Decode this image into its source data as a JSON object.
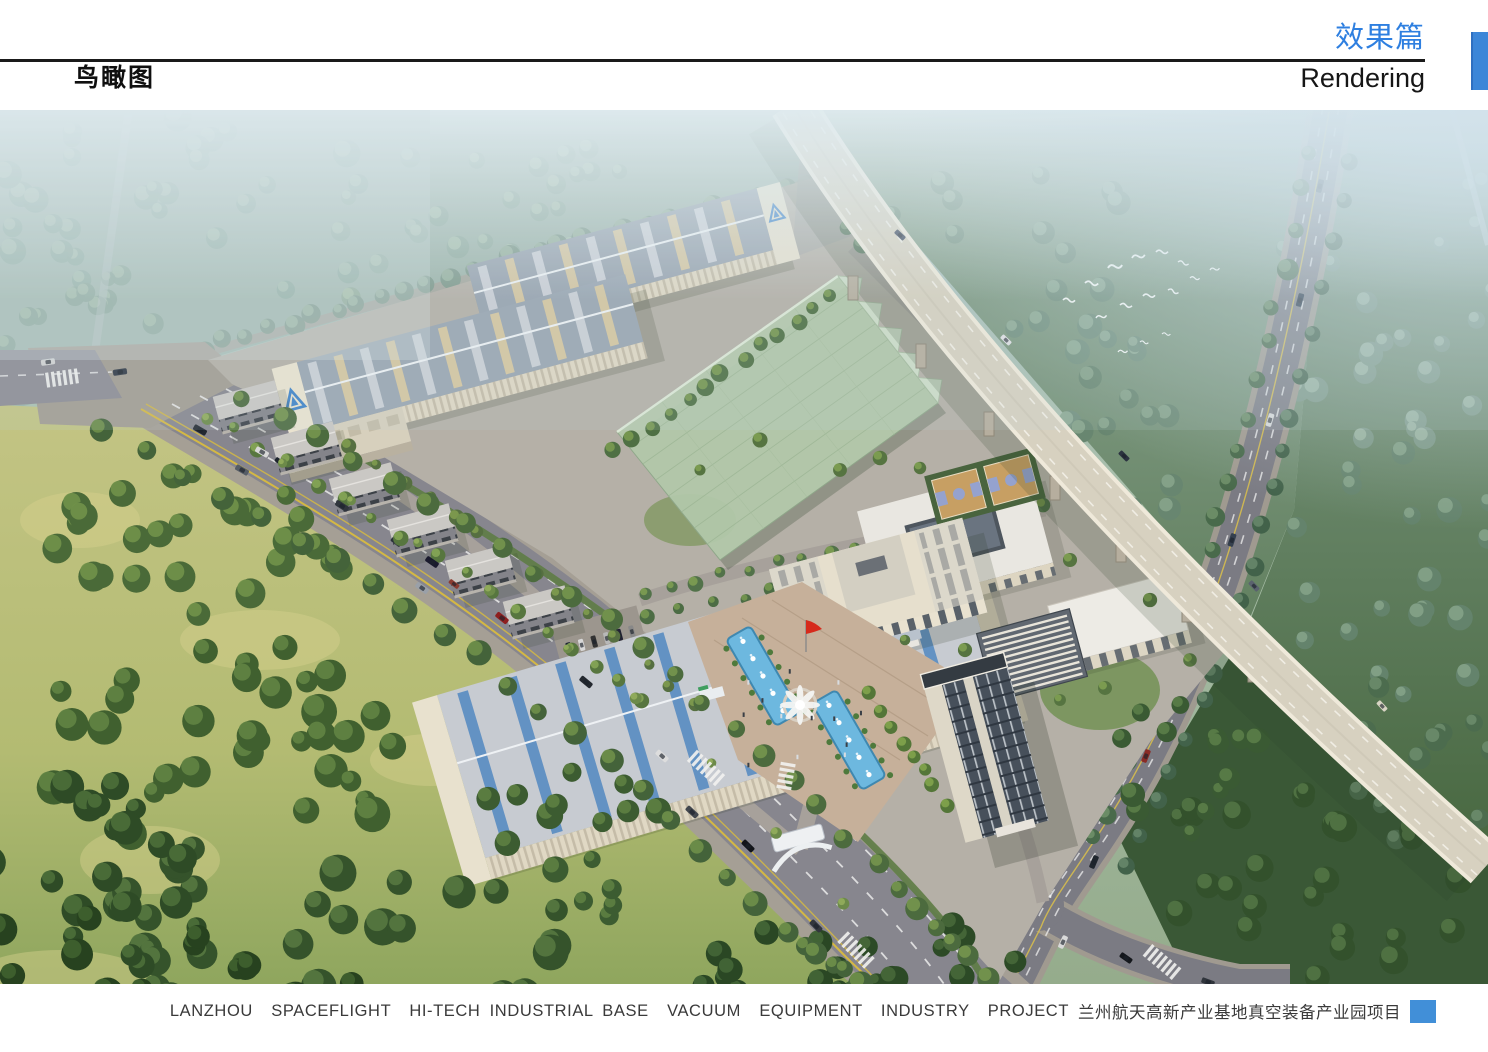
{
  "header": {
    "page_title": "鸟瞰图",
    "section_title_zh": "效果篇",
    "section_title_en": "Rendering"
  },
  "footer": {
    "caption_en": "LANZHOU  SPACEFLIGHT  HI-TECH INDUSTRIAL BASE  VACUUM  EQUIPMENT  INDUSTRY  PROJECT",
    "caption_zh": "兰州航天高新产业基地真空装备产业园项目"
  },
  "colors": {
    "accent_blue": "#3c86d8",
    "section_title_blue": "#2e7fe0",
    "header_rule_black": "#1a1a1a",
    "caption_text_grey": "#3a3a3a",
    "caption_square_blue": "#418fd8",
    "flag_red": "#d62a1c",
    "pool_water_blue": "#6db8df",
    "glass_hall_green": "#b5cbad"
  }
}
